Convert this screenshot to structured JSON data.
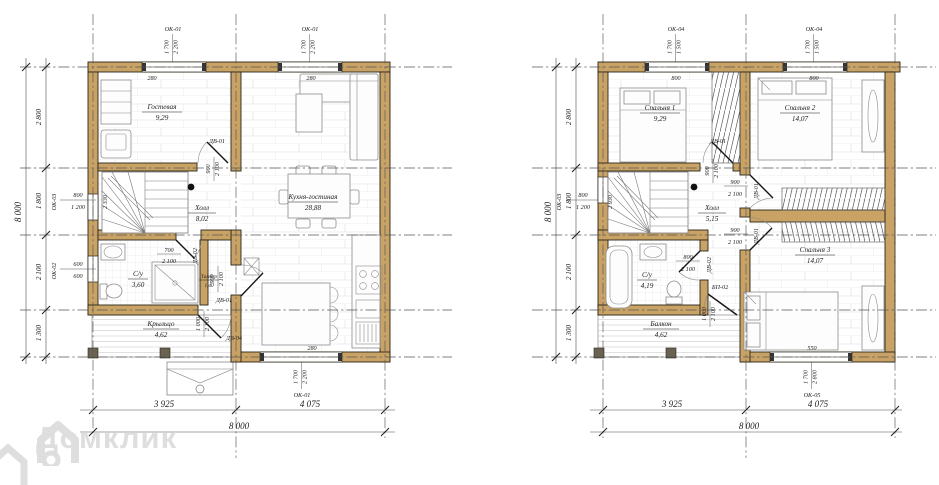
{
  "watermark": {
    "brand": "Домклик"
  },
  "first_floor": {
    "rooms": [
      {
        "name": "Гостевая",
        "area": "9,29"
      },
      {
        "name": "Холл",
        "area": "8,02"
      },
      {
        "name": "Кухня-гостиная",
        "area": "28,88"
      },
      {
        "name": "С/у",
        "area": "3,60"
      },
      {
        "name": "Тамбур",
        "area": "1,40"
      },
      {
        "name": "Крыльцо",
        "area": "4,62"
      }
    ],
    "windows": [
      {
        "label": "ОК-01",
        "width": "1 700",
        "height": "2 200",
        "offset": "280"
      },
      {
        "label": "ОК-01",
        "width": "1 700",
        "height": "2 200",
        "offset": "280"
      },
      {
        "label": "ОК-03",
        "width": "800",
        "height": "1 200"
      },
      {
        "label": "ОК-02",
        "width": "600",
        "height": "600"
      },
      {
        "label": "ОК-01",
        "width": "1 700",
        "height": "2 200",
        "offset": "280"
      }
    ],
    "doors": [
      {
        "label": "ДВ-01",
        "width": "900",
        "height": "2 100"
      },
      {
        "label": "ДВ-02",
        "width": "700",
        "height": "2 100"
      },
      {
        "label": "ДВ-01",
        "width": "900",
        "height": "2 100"
      },
      {
        "label": "ДВ-04",
        "width": "1 000",
        "height": "2 100"
      }
    ],
    "stair_width": "2 330",
    "dims": {
      "left": [
        "2 800",
        "1 800",
        "2 100",
        "1 300"
      ],
      "left_total": "8 000",
      "bottom": [
        "3 925",
        "4 075"
      ],
      "bottom_total": "8 000"
    }
  },
  "second_floor": {
    "rooms": [
      {
        "name": "Спальня 1",
        "area": "9,29"
      },
      {
        "name": "Спальня 2",
        "area": "14,07"
      },
      {
        "name": "Холл",
        "area": "5,15"
      },
      {
        "name": "С/у",
        "area": "4,19"
      },
      {
        "name": "Спальня 3",
        "area": "14,07"
      },
      {
        "name": "Балкон",
        "area": "4,62"
      }
    ],
    "windows": [
      {
        "label": "ОК-04",
        "width": "1 700",
        "height": "1 500",
        "offset": "800"
      },
      {
        "label": "ОК-04",
        "width": "1 700",
        "height": "1 500",
        "offset": "800"
      },
      {
        "label": "ОК-03",
        "width": "800",
        "height": "1 200"
      },
      {
        "label": "ОК-05",
        "width": "1 700",
        "height": "2 800",
        "offset": "550"
      }
    ],
    "doors": [
      {
        "label": "ДВ-01",
        "width": "900",
        "height": "2 100"
      },
      {
        "label": "ДВ-01",
        "width": "900",
        "height": "2 100"
      },
      {
        "label": "ДВ-01",
        "width": "900",
        "height": "2 100"
      },
      {
        "label": "ДВ-02",
        "width": "800",
        "height": "2 100"
      },
      {
        "label": "БП-02",
        "width": "1 000",
        "height": "2 100"
      }
    ],
    "stair_width": "2 930",
    "dims": {
      "left": [
        "2 800",
        "1 800",
        "2 100",
        "1 300"
      ],
      "left_total": "8 000",
      "bottom": [
        "3 925",
        "4 075"
      ],
      "bottom_total": "8 000"
    }
  }
}
